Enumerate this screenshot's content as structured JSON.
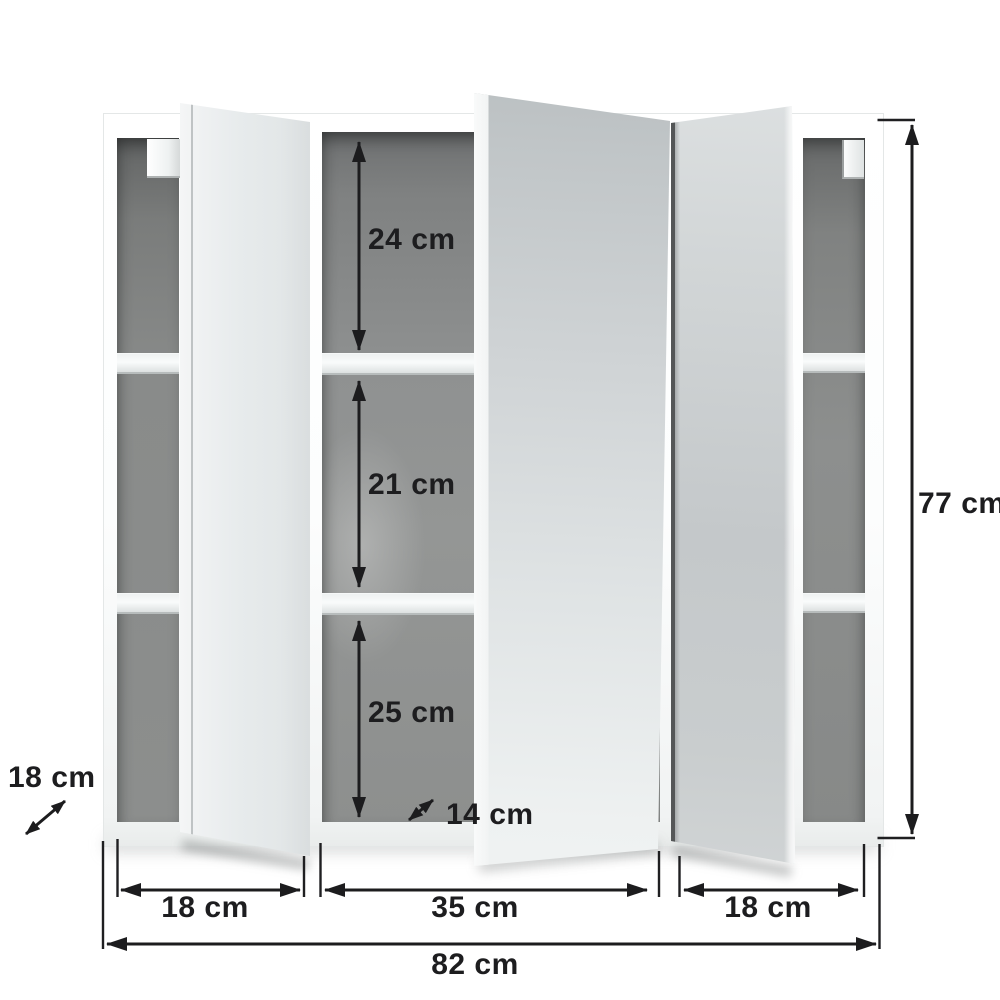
{
  "diagram": {
    "subject": "Three-door mirrored bathroom wall cabinet — dimension drawing",
    "units": "cm",
    "labels": {
      "inner_top_height": "24 cm",
      "inner_middle_height": "21 cm",
      "inner_bottom_height": "25 cm",
      "inner_depth": "14 cm",
      "side_shelf_depth": "18 cm",
      "total_height": "77 cm",
      "left_door_width": "18 cm",
      "middle_door_width": "35 cm",
      "right_door_width": "18 cm",
      "total_width": "82 cm"
    },
    "measurements": {
      "inner_top_height_cm": 24,
      "inner_middle_height_cm": 21,
      "inner_bottom_height_cm": 25,
      "inner_depth_cm": 14,
      "side_shelf_depth_cm": 18,
      "total_height_cm": 77,
      "left_door_width_cm": 18,
      "middle_door_width_cm": 35,
      "right_door_width_cm": 18,
      "total_width_cm": 82
    },
    "colors": {
      "dimension_line": "#1c1c1e",
      "label_text": "#1d1d1f",
      "interior_gray": "#8a8c8b",
      "carcass_white": "#fdfdfd",
      "mirror_silver": "#d2d6d8"
    }
  }
}
